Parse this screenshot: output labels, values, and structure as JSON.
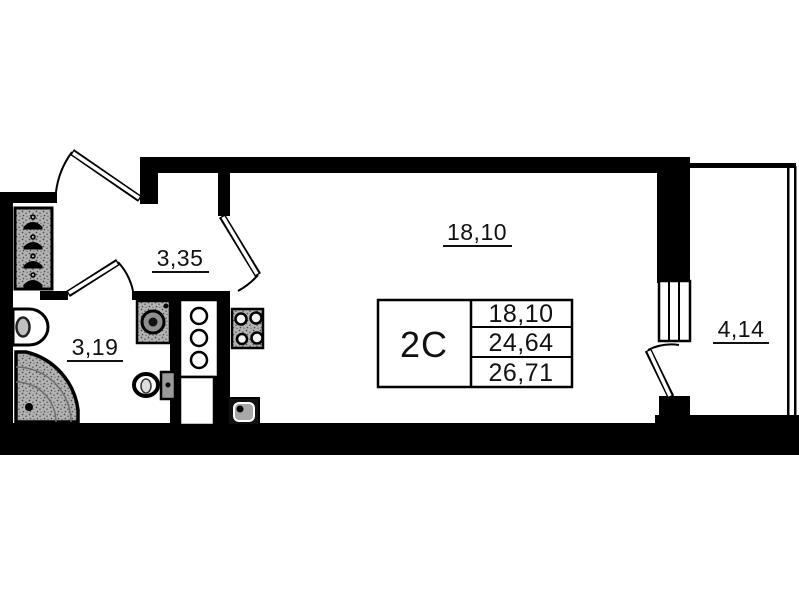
{
  "floor_plan": {
    "unit_label": "2С",
    "rooms": {
      "living": {
        "name": "living-room",
        "area": "18,10"
      },
      "hall": {
        "name": "hallway",
        "area": "3,35"
      },
      "bathroom": {
        "name": "bathroom",
        "area": "3,19"
      },
      "balcony": {
        "name": "balcony",
        "area": "4,14"
      }
    },
    "info_table": {
      "unit": "2С",
      "rows": [
        "18,10",
        "24,64",
        "26,71"
      ]
    },
    "colors": {
      "walls": "#000000",
      "fixture_fill": "#b3b3b3",
      "background": "#ffffff",
      "text": "#111111"
    }
  }
}
